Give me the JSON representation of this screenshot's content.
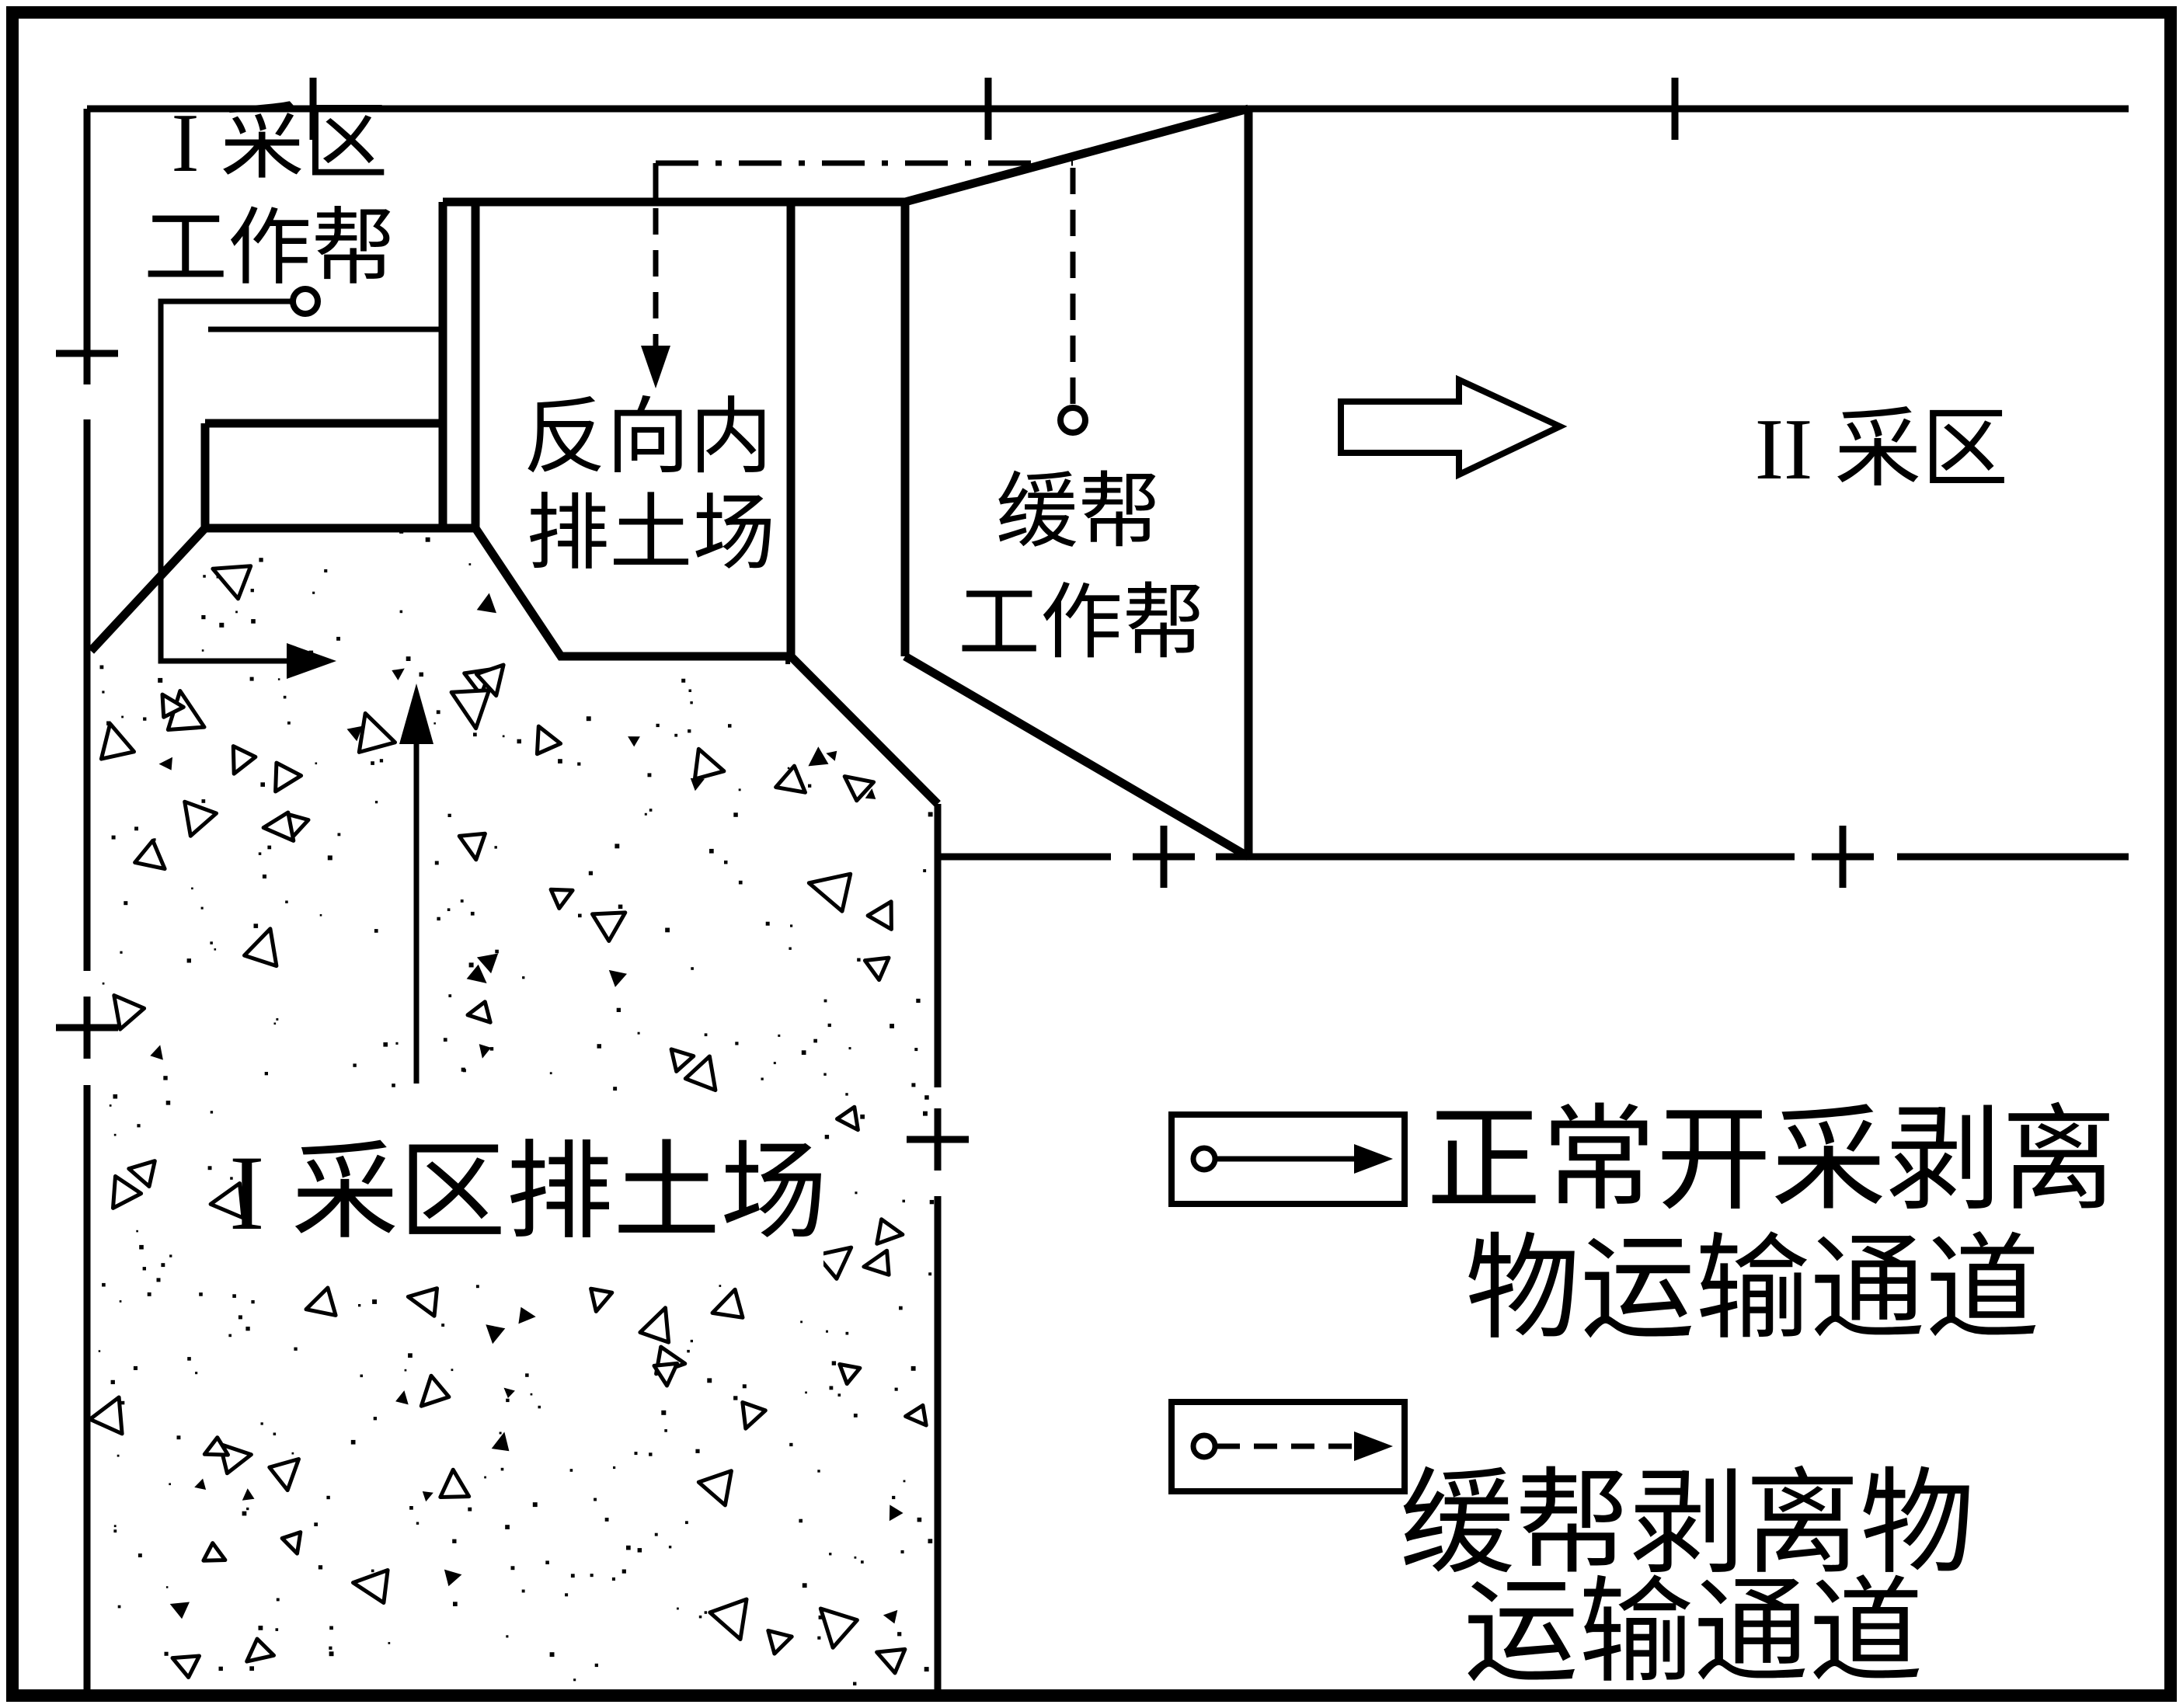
{
  "colors": {
    "line": "#000000",
    "background": "#ffffff"
  },
  "labels": {
    "zone1_slope_line1": "I 采区",
    "zone1_slope_line2": "工作帮",
    "reverse_dump_line1": "反向内",
    "reverse_dump_line2": "排土场",
    "buffer_slope_line1": "缓帮",
    "buffer_slope_line2": "工作帮",
    "zone2": "II 采区",
    "zone1_dump": "I 采区排土场"
  },
  "legend": {
    "normal": {
      "symbol": "circle-solid-arrow",
      "line1": "正常开采剥离",
      "line2": "物运输通道"
    },
    "buffer": {
      "symbol": "circle-dashdot-arrow",
      "line1": "缓帮剥离物",
      "line2": "运输通道"
    }
  }
}
